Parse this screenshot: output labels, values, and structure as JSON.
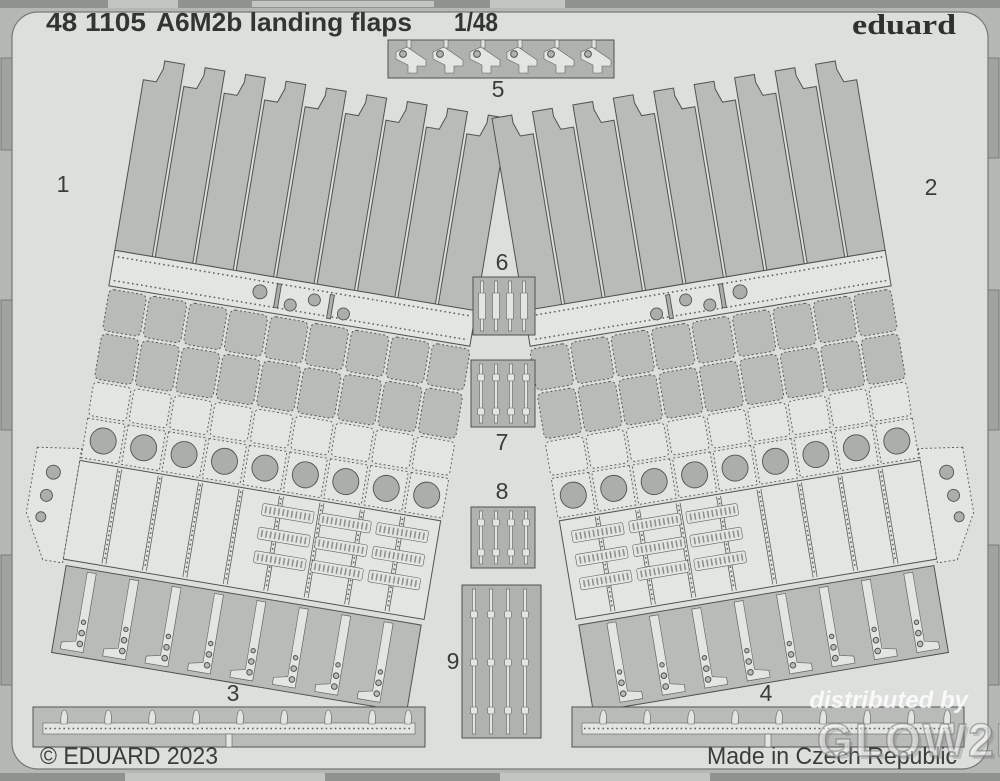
{
  "header": {
    "catalog": "48 1105",
    "product_name": "A6M2b landing flaps",
    "scale": "1/48",
    "brand": "eduard"
  },
  "footer": {
    "copyright": "© EDUARD 2023",
    "made_in": "Made in Czech Republic"
  },
  "watermark": {
    "line1": "distributed by",
    "line2": "GLOW2B"
  },
  "parts": [
    {
      "number": "1"
    },
    {
      "number": "2"
    },
    {
      "number": "3"
    },
    {
      "number": "4"
    },
    {
      "number": "5"
    },
    {
      "number": "6"
    },
    {
      "number": "7"
    },
    {
      "number": "8"
    },
    {
      "number": "9"
    }
  ],
  "colors": {
    "fret_band": "#b4b7b3",
    "fret_field": "#dcdfdb",
    "part_medium": "#b8bbb7",
    "part_light": "#e3e5e1",
    "hole": "#abaeaa",
    "text": "#333633",
    "watermark": "#ffffff"
  }
}
